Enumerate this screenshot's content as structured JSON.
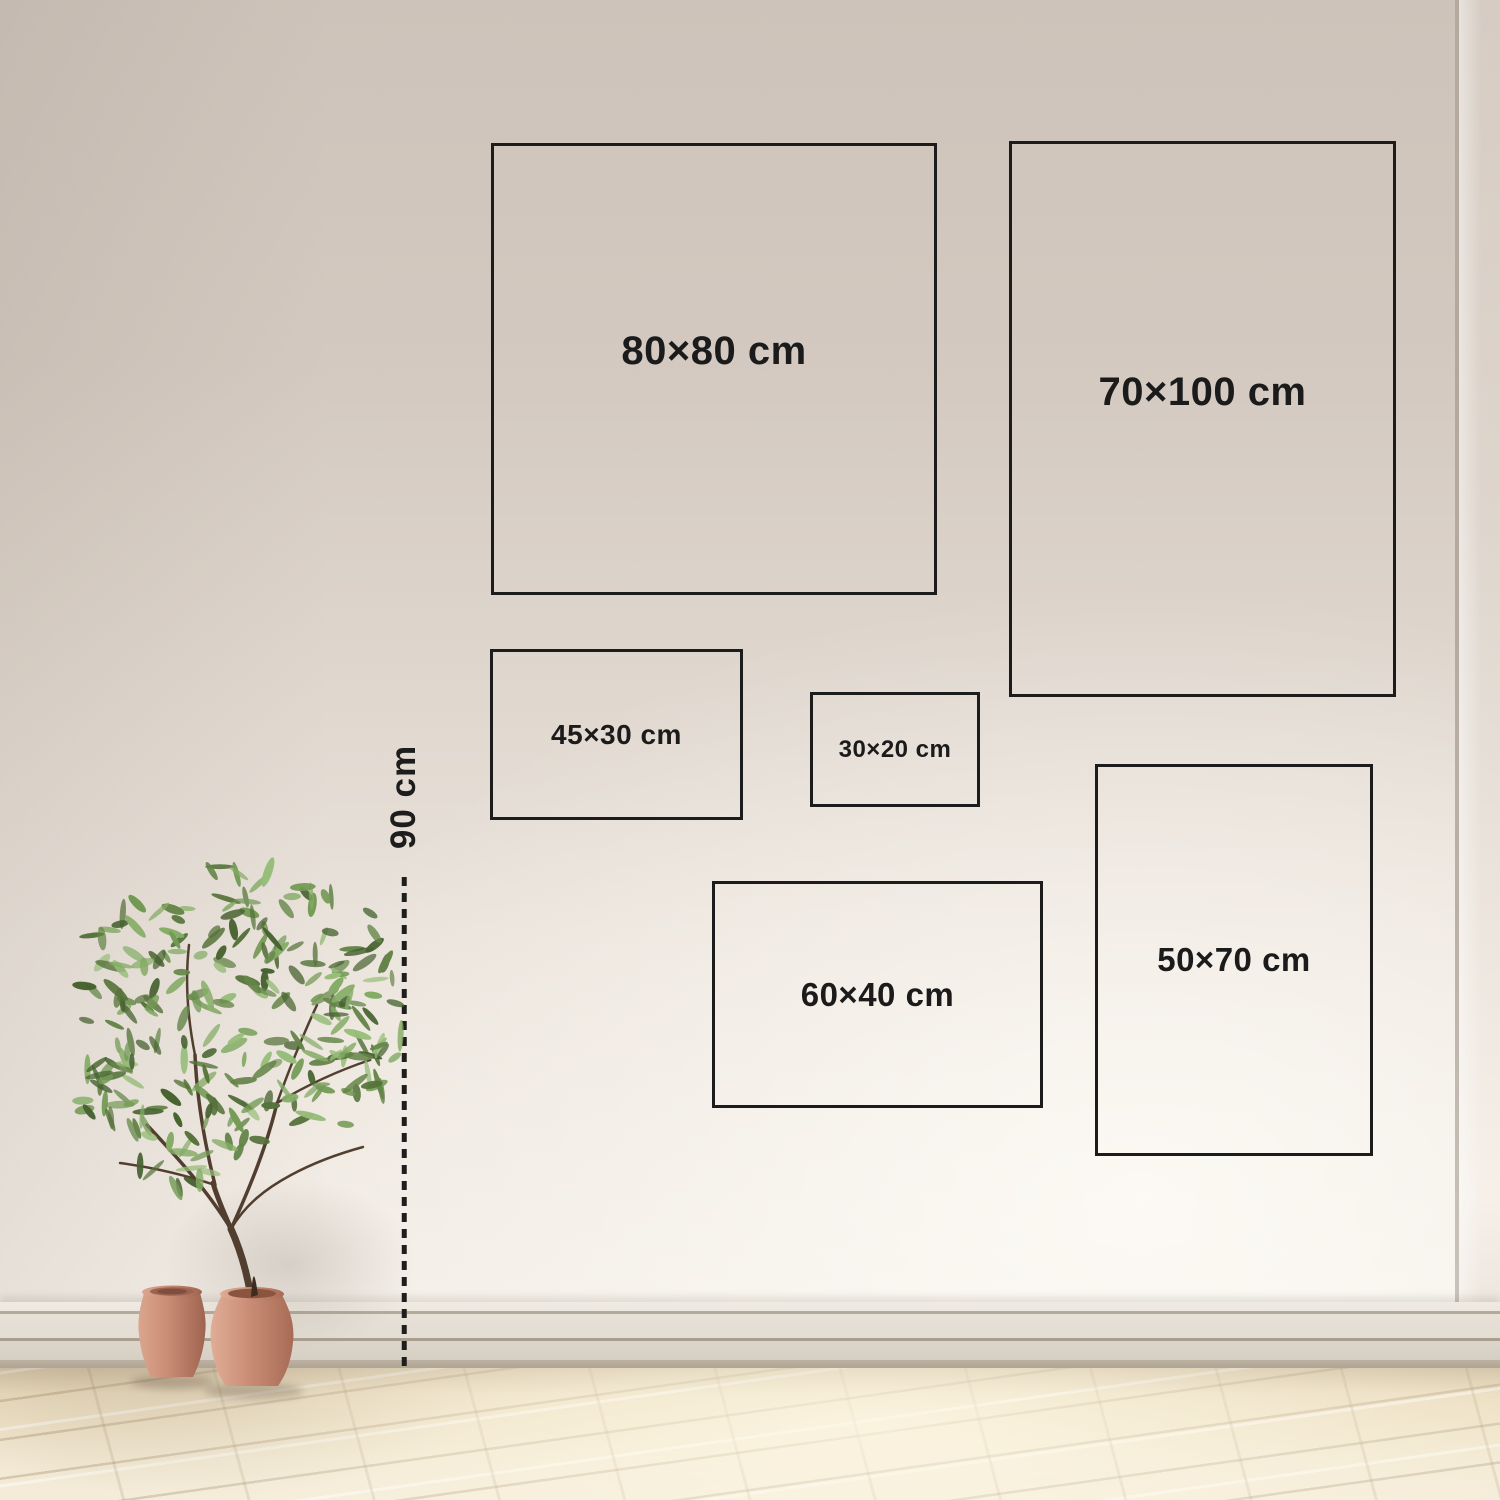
{
  "size_guide": {
    "boxes": [
      {
        "id": "80x80",
        "label": "80×80 cm"
      },
      {
        "id": "70x100",
        "label": "70×100 cm"
      },
      {
        "id": "45x30",
        "label": "45×30 cm"
      },
      {
        "id": "30x20",
        "label": "30×20 cm"
      },
      {
        "id": "60x40",
        "label": "60×40 cm"
      },
      {
        "id": "50x70",
        "label": "50×70 cm"
      }
    ],
    "height_marker": {
      "label": "90 cm"
    }
  },
  "style": {
    "ink_color": "#1c1c1c",
    "wall_top_color": "#cdc3ba",
    "wall_bottom_color": "#f3eee7",
    "baseboard_color": "#e3ddd4",
    "floor_color": "#eee1c6",
    "pot_color": "#c98b73",
    "leaf_color": "#648548",
    "trunk_color": "#4a3626"
  }
}
